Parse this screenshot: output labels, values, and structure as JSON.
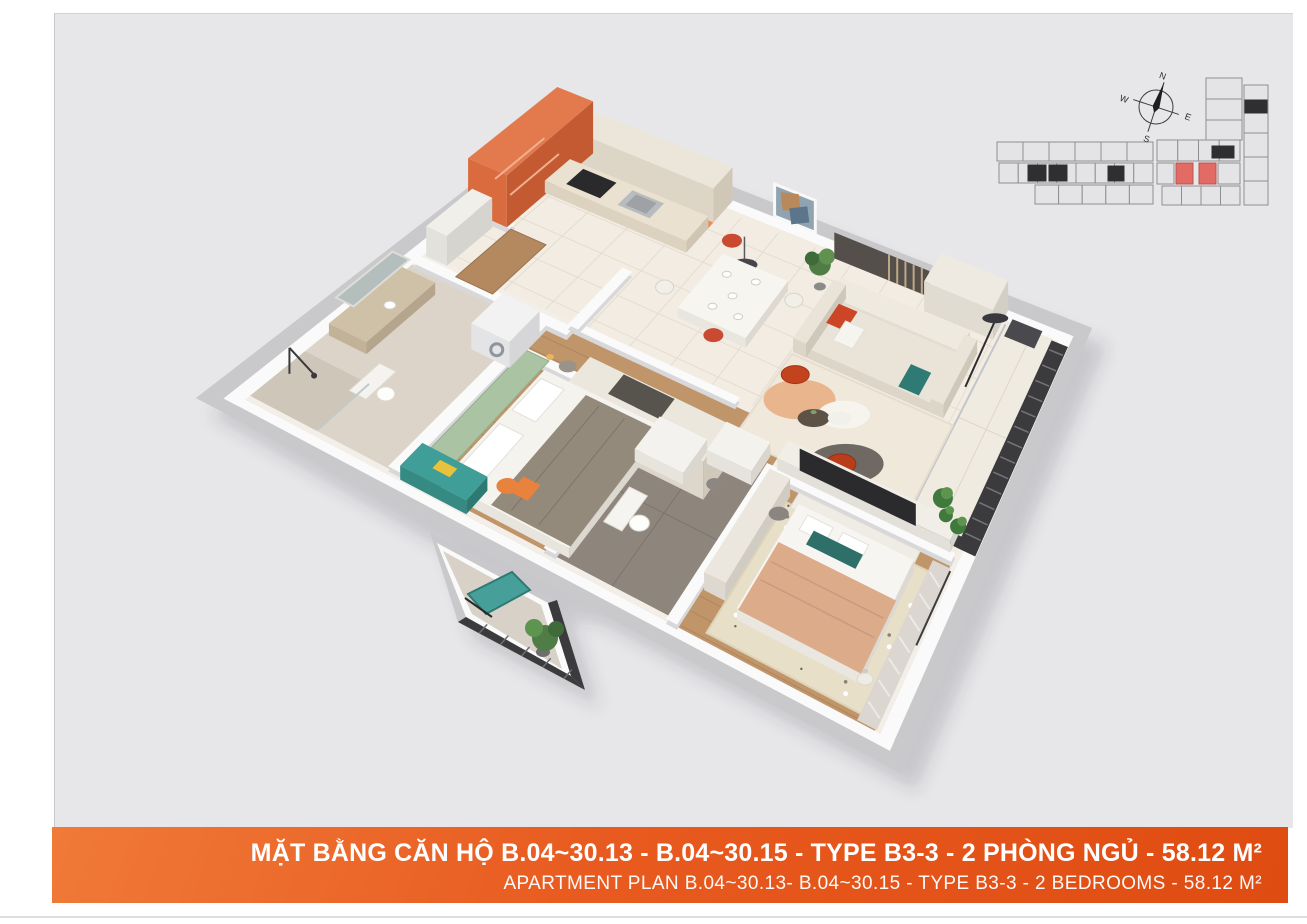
{
  "banner": {
    "title_vi": "MẶT BẰNG CĂN HỘ B.04~30.13 - B.04~30.15 - TYPE B3-3 - 2 PHÒNG NGỦ - 58.12 M²",
    "title_en": "APARTMENT PLAN B.04~30.13- B.04~30.15 - TYPE B3-3 - 2 BEDROOMS - 58.12 M²",
    "gradient_start": "#f07a38",
    "gradient_end": "#df4c12",
    "text_color": "#ffffff"
  },
  "compass": {
    "north": "N",
    "east": "E",
    "south": "S",
    "west": "W"
  },
  "key_plan": {
    "unit_fill": "#e4e4e6",
    "unit_stroke": "#8f8f93",
    "core_fill": "#2f2f31",
    "highlight_fill": "#e26b66",
    "highlight_stroke": "#b95551",
    "highlighted_unit_count": 2
  },
  "palette": {
    "panel_bg": "#e7e7e9",
    "wall_top": "#c9c9cc",
    "wall_face": "#fafafa",
    "floor_base": "#f3efe8",
    "marble": "#f2ece3",
    "wood": "#c0956a",
    "bath1_tile": "#dcd4c8",
    "bath2_tile": "#8e857d",
    "balcony_tile": "#d8d1c7",
    "accent_orange": "#e27a4e",
    "teal_furniture": "#3f9e97",
    "sage_headboard": "#a9c3a3",
    "sofa_beige": "#e9e3d8",
    "rug_cream": "#efe8db",
    "pouf_red": "#c2431e",
    "blanket_tan": "#dcab8a",
    "railing_dark": "#3b3b3e",
    "plant_green": "#4f7d45"
  }
}
